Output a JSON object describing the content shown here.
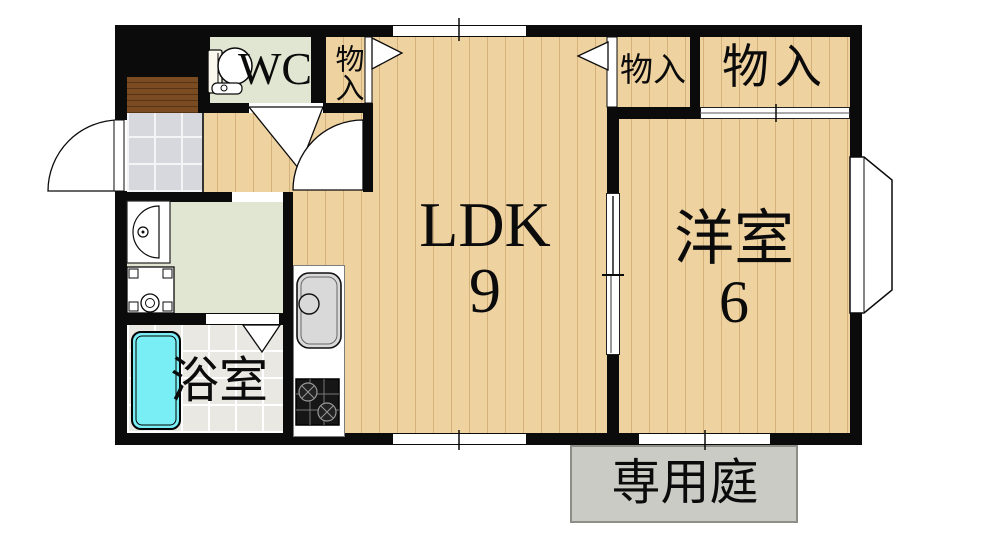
{
  "plan": {
    "labels": {
      "wc": "WC",
      "closet_hall": "物入",
      "closet_small": "物入",
      "closet_large": "物入",
      "ldk": "LDK",
      "ldk_size": "9",
      "western_room": "洋室",
      "western_size": "6",
      "bathroom": "浴室",
      "private_garden": "専用庭"
    },
    "colors": {
      "wall": "#0b0b0b",
      "wood_floor": "#eed2a0",
      "wet_area_floor": "#e1e6d2",
      "bathroom_tile": "#eae8e3",
      "entrance_tile": "#d7d8dd",
      "entrance_step": "#7b4b21",
      "bathtub": "#79eef5",
      "garden": "#cbcbc6",
      "kitchen_sink": "#d9d9d9",
      "gas_stove": "#161616"
    }
  }
}
